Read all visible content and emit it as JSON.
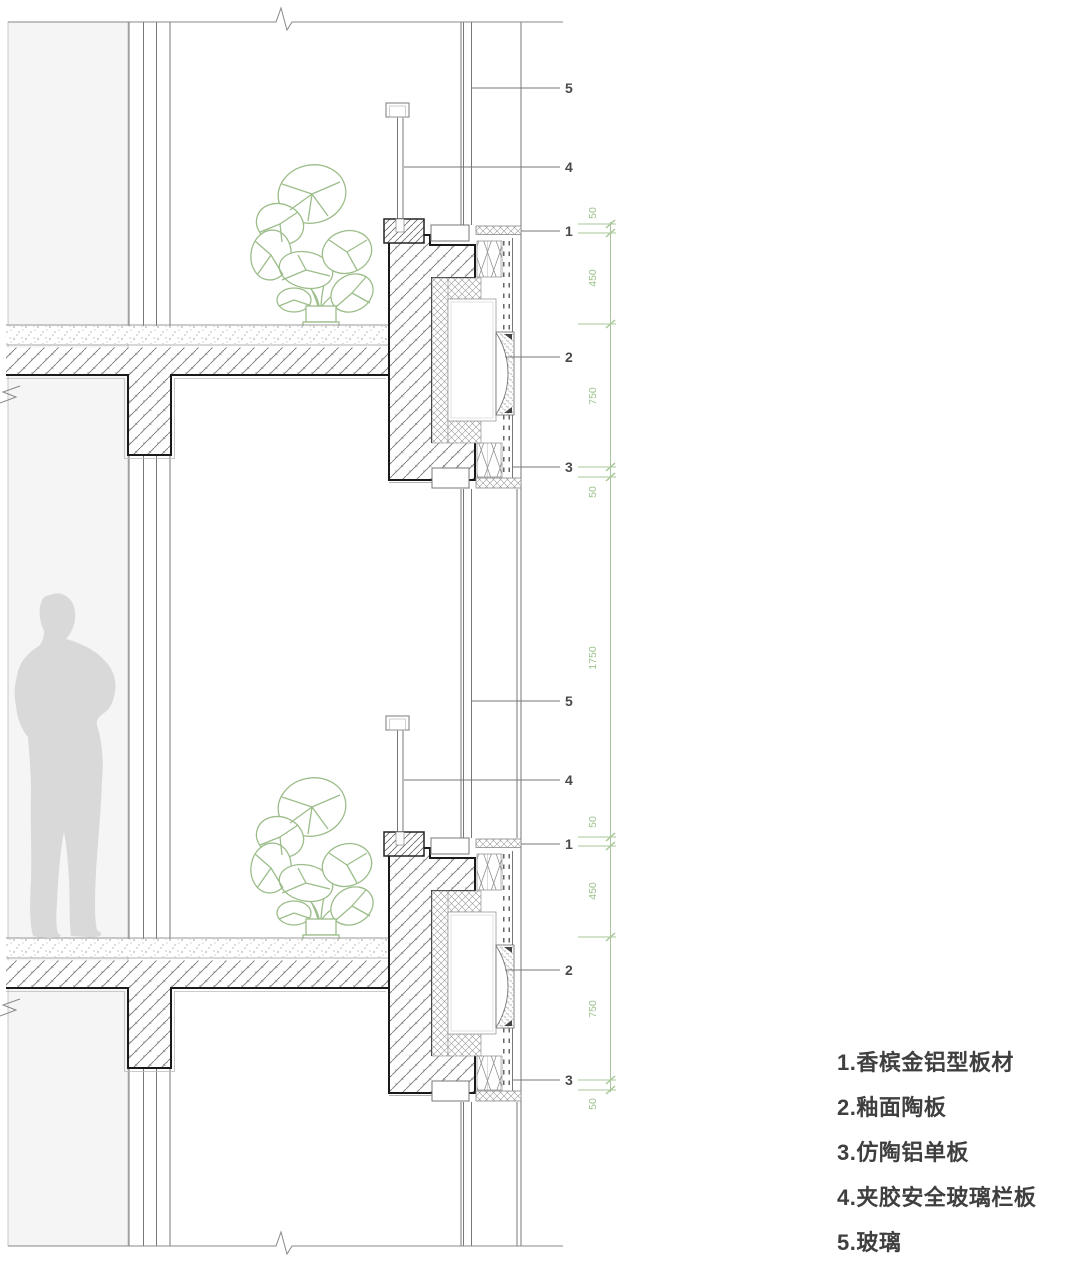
{
  "legend": {
    "items": [
      "1.香槟金铝型板材",
      "2.釉面陶板",
      "3.仿陶铝单板",
      "4.夹胶安全玻璃栏板",
      "5.玻璃"
    ]
  },
  "callouts": [
    "5",
    "4",
    "1",
    "2",
    "3"
  ],
  "dimensions": [
    "50",
    "450",
    "750",
    "50",
    "1750",
    "50",
    "450",
    "750",
    "50"
  ],
  "colors": {
    "dimension_green": "#a9c79a",
    "dimension_text_green": "#9ec28d",
    "drawing_line_gray": "#777777",
    "outline_dark": "#1a1a1a",
    "callout_text": "#4a4a4a",
    "legend_text": "#3f3f3f",
    "silhouette_gray": "#d9d9d9",
    "plant_green": "#9cbd8a",
    "interior_panel_fill": "#f5f5f5"
  }
}
